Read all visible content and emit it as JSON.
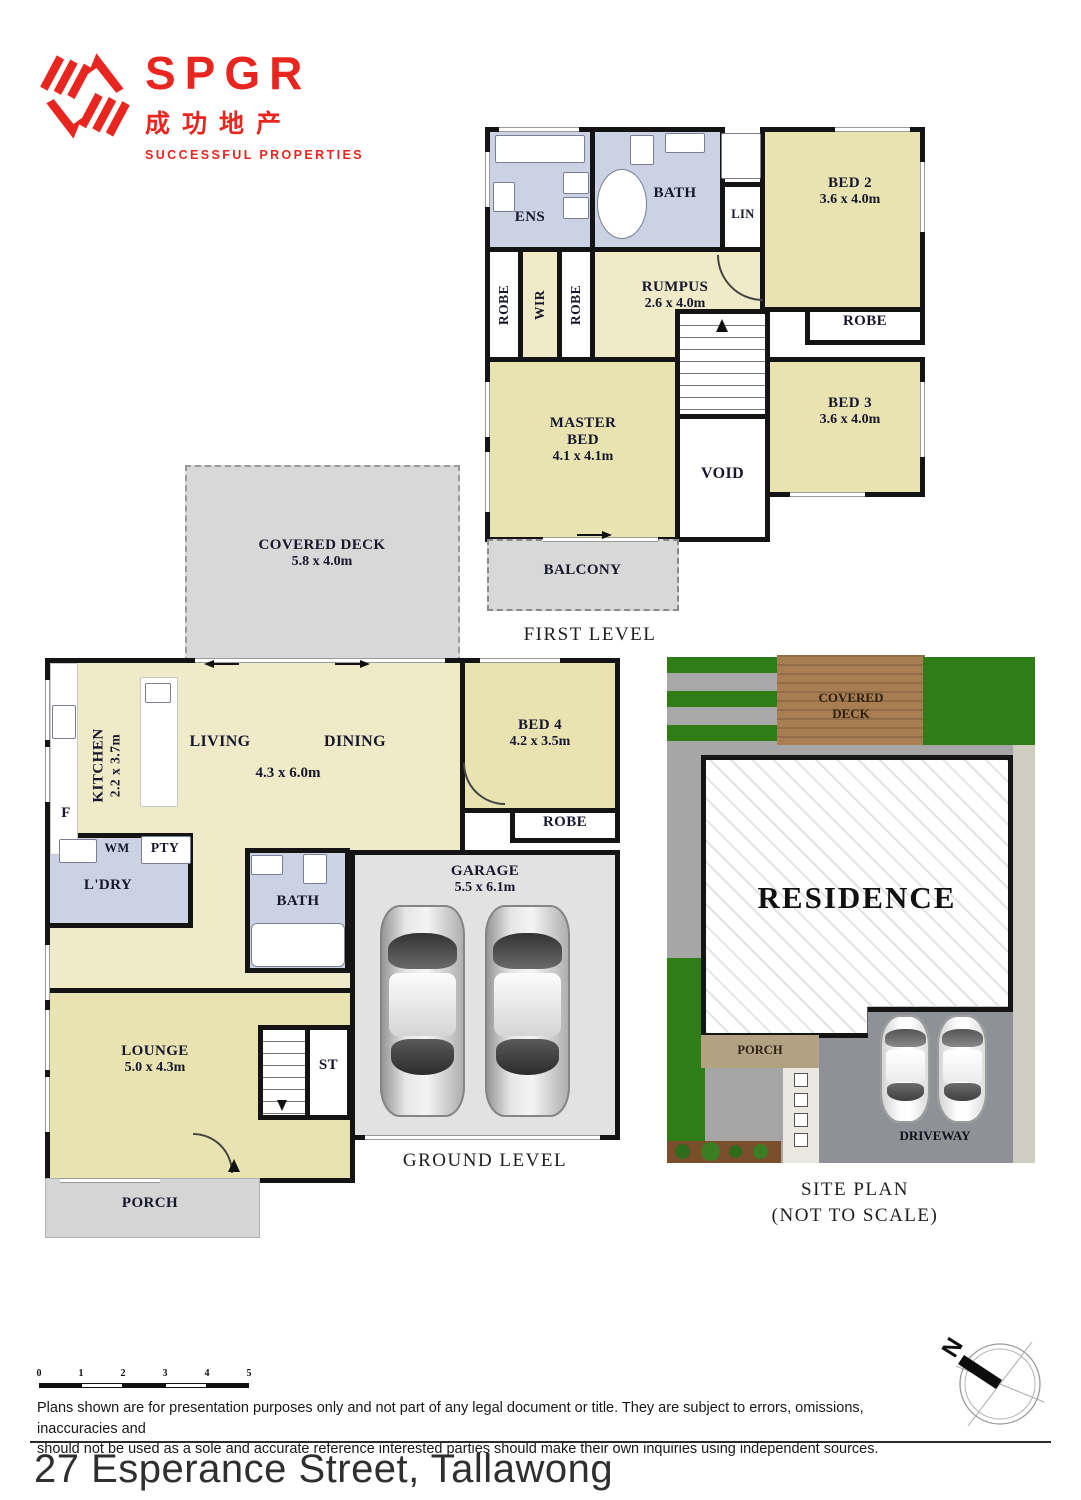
{
  "logo": {
    "brand": "SPGR",
    "chinese": "成功地产",
    "tagline": "SUCCESSFUL PROPERTIES",
    "accent_color": "#e8251f"
  },
  "first_level": {
    "caption": "FIRST LEVEL",
    "rooms": {
      "ens": "ENS",
      "bath": "BATH",
      "lin": "LIN",
      "robe_left": "ROBE",
      "wir": "WIR",
      "robe_right": "ROBE",
      "rumpus": "RUMPUS",
      "rumpus_dims": "2.6 x 4.0m",
      "bed2": "BED 2",
      "bed2_dims": "3.6 x 4.0m",
      "bed2_robe": "ROBE",
      "bed3": "BED 3",
      "bed3_dims": "3.6 x 4.0m",
      "master": "MASTER BED",
      "master_dims": "4.1 x 4.1m",
      "void": "VOID",
      "balcony": "BALCONY"
    }
  },
  "ground_level": {
    "caption": "GROUND LEVEL",
    "rooms": {
      "covered_deck": "COVERED DECK",
      "covered_deck_dims": "5.8 x 4.0m",
      "kitchen": "KITCHEN",
      "kitchen_dims": "2.2 x 3.7m",
      "living": "LIVING",
      "dining": "DINING",
      "living_dining_dims": "4.3 x 6.0m",
      "bed4": "BED 4",
      "bed4_dims": "4.2 x 3.5m",
      "bed4_robe": "ROBE",
      "fridge": "F",
      "wm": "WM",
      "pty": "PTY",
      "ldry": "L'DRY",
      "bath": "BATH",
      "garage": "GARAGE",
      "garage_dims": "5.5 x 6.1m",
      "lounge": "LOUNGE",
      "lounge_dims": "5.0 x 4.3m",
      "st": "ST",
      "porch": "PORCH"
    }
  },
  "site_plan": {
    "caption": "SITE PLAN",
    "caption_note": "(NOT TO SCALE)",
    "covered_deck": "COVERED DECK",
    "residence": "RESIDENCE",
    "porch": "PORCH",
    "driveway": "DRIVEWAY"
  },
  "footer": {
    "scale_ticks": [
      "0",
      "1",
      "2",
      "3",
      "4",
      "5"
    ],
    "disclaimer_line1": "Plans shown are for presentation purposes only and not part of any legal document or title. They are subject to errors, omissions, inaccuracies and",
    "disclaimer_line2": "should not be used as a sole and accurate reference interested parties should make their own inquiries using independent sources.",
    "address": "27 Esperance Street, Tallawong",
    "compass_n": "N"
  }
}
